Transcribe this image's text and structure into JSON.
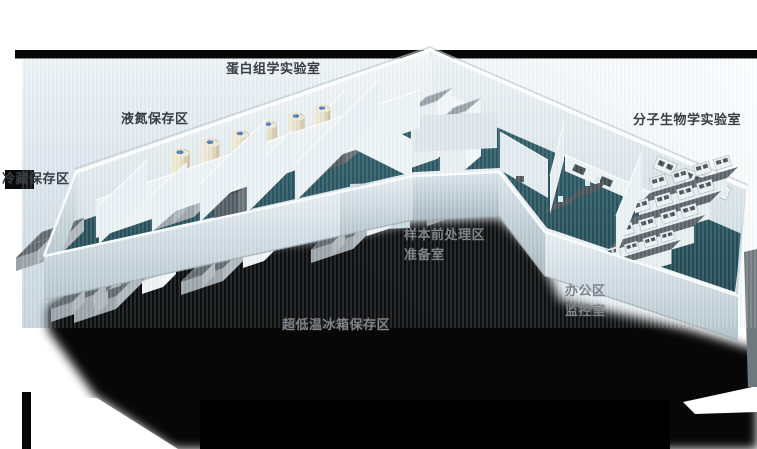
{
  "scene": {
    "description": "3D isometric cutaway floor plan of a biobank laboratory",
    "labels": {
      "proteomics_lab": "蛋白组学实验室",
      "liquid_nitrogen_area": "液氮保存区",
      "cold_storage_area": "冷藏保存区",
      "molecular_biology_lab": "分子生物学实验室",
      "sample_pretreatment_area": "样本前处理区",
      "preparation_room": "准备室",
      "ult_freezer_area": "超低温冰箱保存区",
      "office_area": "办公区",
      "monitoring_room": "监控室"
    },
    "colors": {
      "floor_teal": "#24505a",
      "wall_light": "#e8eff2",
      "backdrop_blue": "#c9d7e0",
      "shadow": "#000000",
      "label_dark": "#393d44",
      "label_light": "#7e848a",
      "tank_cream": "#ece4d0",
      "freezer_gray": "#5c656a",
      "tank_cap_blue": "#4a78b2"
    }
  }
}
